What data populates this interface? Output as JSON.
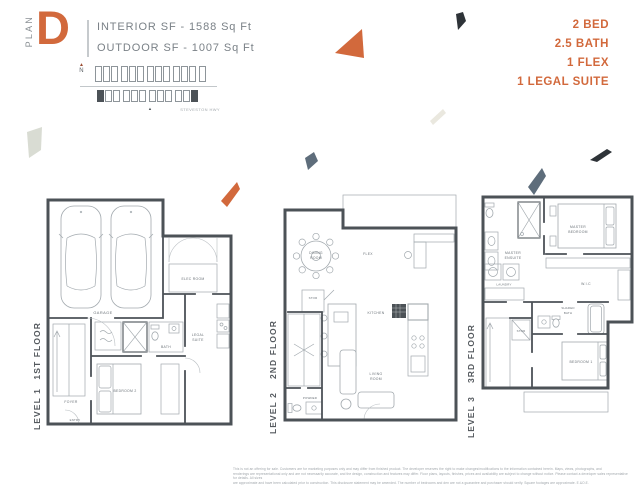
{
  "header": {
    "plan_word": "PLAN",
    "plan_letter": "D",
    "interior_sf": "INTERIOR SF - 1588 Sq Ft",
    "outdoor_sf": "OUTDOOR SF - 1007 Sq Ft",
    "features": [
      "2 BED",
      "2.5 BATH",
      "1 FLEX",
      "1 LEGAL SUITE"
    ]
  },
  "sitemap": {
    "north": "N",
    "north_arrow": "▲",
    "street": "STEVESTON HWY",
    "marker": "▲",
    "top_units": 13,
    "bottom_units": 12,
    "highlighted_bottom": [
      0,
      11
    ]
  },
  "floors": {
    "f1": {
      "title": "1ST FLOOR",
      "level": "LEVEL 1",
      "rooms": {
        "garage": "GARAGE",
        "elec": "ELEC ROOM",
        "bath": "BATH",
        "legal_l1": "LEGAL",
        "legal_l2": "SUITE",
        "foyer": "FOYER",
        "bedroom2": "BEDROOM 2",
        "entry": "ENTRY"
      }
    },
    "f2": {
      "title": "2ND FLOOR",
      "level": "LEVEL 2",
      "rooms": {
        "dining_l1": "DINING",
        "dining_l2": "ROOM",
        "flex": "FLEX",
        "stor": "STOR",
        "kitchen": "KITCHEN",
        "living_l1": "LIVING",
        "living_l2": "ROOM",
        "powder": "POWDER"
      }
    },
    "f3": {
      "title": "3RD FLOOR",
      "level": "LEVEL 3",
      "rooms": {
        "ensuite_l1": "MASTER",
        "ensuite_l2": "ENSUITE",
        "master_l1": "MASTER",
        "master_l2": "BEDROOM",
        "wic": "W.I.C",
        "laundry": "LAUNDRY",
        "stor": "STOR",
        "shared_l1": "SHARED",
        "shared_l2": "BATH",
        "bedroom1": "BEDROOM 1"
      }
    }
  },
  "colors": {
    "accent": "#D2693C",
    "wall": "#4C5257",
    "line": "#A2A9AE",
    "label": "#6B7278"
  },
  "decor": {
    "orange": "#D2693C",
    "ink": "#2E3338",
    "slate": "#5E6D7B",
    "beige": "#EAE8DF",
    "sage": "#D9DCD3"
  },
  "disclaimer": [
    "This is not an offering for sale. Customers are for marketing purposes only and may differ from finished product. The developer reserves the right to make changes/modifications to the information contained herein. Maps, views, photographs, and",
    "renderings are representational only and are not necessarily accurate, and the design, construction and features may differ. Floor plans, layouts, finishes, prices and availability are subject to change without notice. Please contact a developer sales representative for details. All sizes",
    "are approximate and have been calculated prior to construction. This disclosure statement may be amended. The number of bedrooms and den are not a guarantee and purchaser should verify. Square footages are approximate. E.&O.E."
  ]
}
